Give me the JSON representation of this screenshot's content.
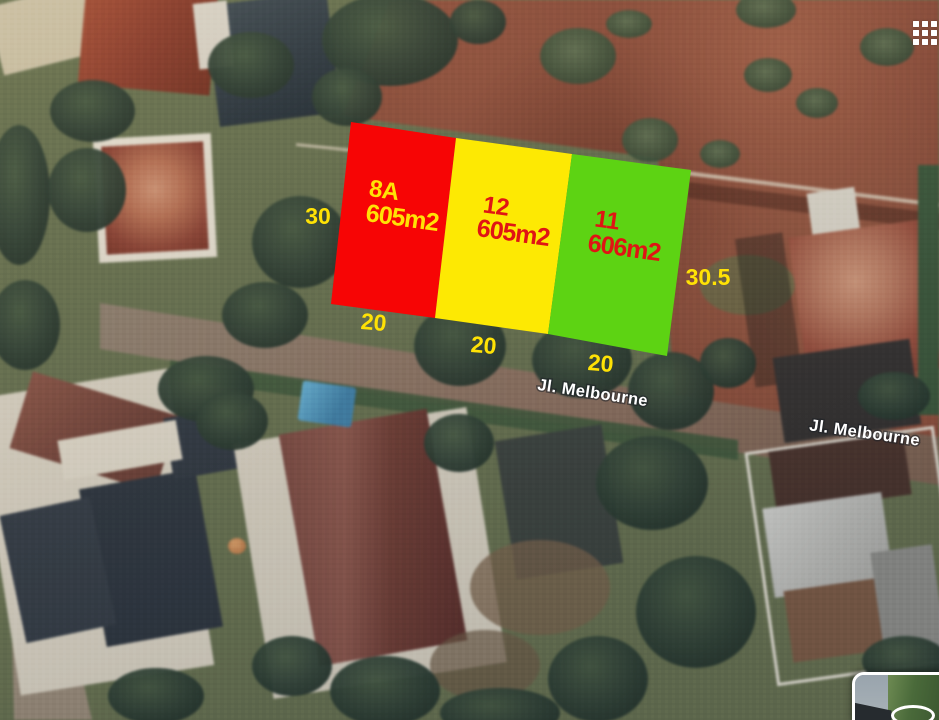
{
  "map_overlay": {
    "plots": [
      {
        "name": "8A",
        "area": "605m2",
        "frontage": "20",
        "fill": "#f70505",
        "label_color": "#ffe205"
      },
      {
        "name": "12",
        "area": "605m2",
        "frontage": "20",
        "fill": "#fde903",
        "label_color": "#e01414"
      },
      {
        "name": "11",
        "area": "606m2",
        "frontage": "20",
        "fill": "#5dd313",
        "label_color": "#e01414"
      }
    ],
    "side_dimensions": {
      "left": "30",
      "right": "30.5"
    },
    "dimension_color": "#ffe205",
    "street_label_color": "#ffffff",
    "street_labels": [
      {
        "text": "Jl. Melbourne"
      },
      {
        "text": "Jl. Melbourne"
      }
    ]
  },
  "controls": {
    "tiles_grid_icon": "grid-tiles",
    "street_view_thumbnail": "street-view-preview"
  }
}
